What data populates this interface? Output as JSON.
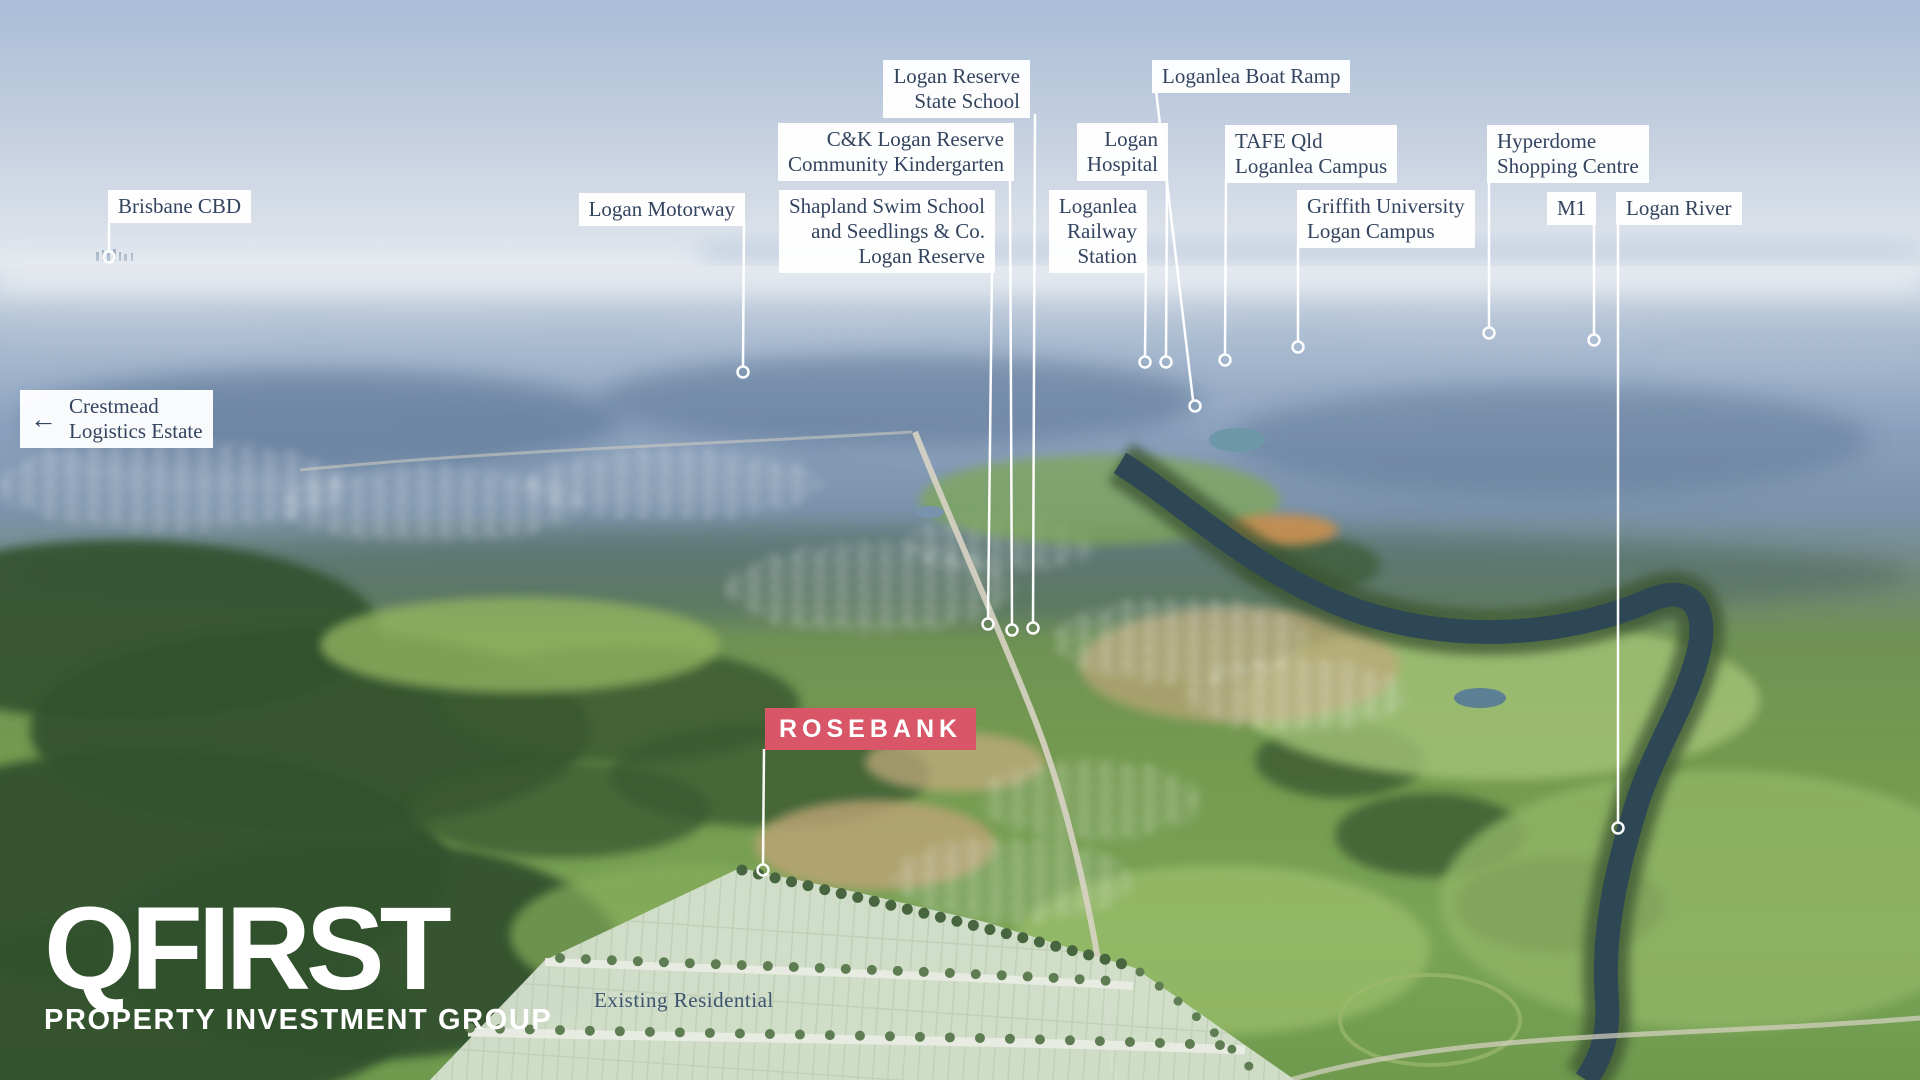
{
  "brand": {
    "logo_line1": "QFIRST",
    "logo_line2": "PROPERTY INVESTMENT GROUP",
    "logo_color": "#ffffff"
  },
  "project_badge": {
    "label": "ROSEBANK",
    "bg_color": "#d85668",
    "text_color": "#ffffff"
  },
  "map_overlay": {
    "existing_residential_label": "Existing Residential"
  },
  "style": {
    "callout_bg": "#ffffff",
    "callout_text_color": "#33445f",
    "leader_line_color": "#ffffff"
  },
  "callouts": [
    {
      "id": "brisbane-cbd",
      "lines": [
        "Brisbane CBD"
      ]
    },
    {
      "id": "crestmead-logistics-estate",
      "arrow": "←",
      "lines": [
        "Crestmead",
        "Logistics Estate"
      ]
    },
    {
      "id": "logan-motorway",
      "lines": [
        "Logan Motorway"
      ]
    },
    {
      "id": "shapland-swim-school",
      "lines": [
        "Shapland Swim School",
        "and Seedlings & Co.",
        "Logan Reserve"
      ]
    },
    {
      "id": "logan-reserve-state-school",
      "lines": [
        "Logan Reserve",
        "State School"
      ]
    },
    {
      "id": "ck-logan-reserve-kindergarten",
      "lines": [
        "C&K Logan Reserve",
        "Community Kindergarten"
      ]
    },
    {
      "id": "logan-hospital",
      "lines": [
        "Logan",
        "Hospital"
      ]
    },
    {
      "id": "loganlea-railway-station",
      "lines": [
        "Loganlea",
        "Railway",
        "Station"
      ]
    },
    {
      "id": "loganlea-boat-ramp",
      "lines": [
        "Loganlea Boat Ramp"
      ]
    },
    {
      "id": "tafe-qld-loganlea-campus",
      "lines": [
        "TAFE Qld",
        "Loganlea Campus"
      ]
    },
    {
      "id": "griffith-university-logan-campus",
      "lines": [
        "Griffith University",
        "Logan Campus"
      ]
    },
    {
      "id": "hyperdome-shopping-centre",
      "lines": [
        "Hyperdome",
        "Shopping Centre"
      ]
    },
    {
      "id": "m1",
      "lines": [
        "M1"
      ]
    },
    {
      "id": "logan-river",
      "lines": [
        "Logan River"
      ]
    }
  ]
}
